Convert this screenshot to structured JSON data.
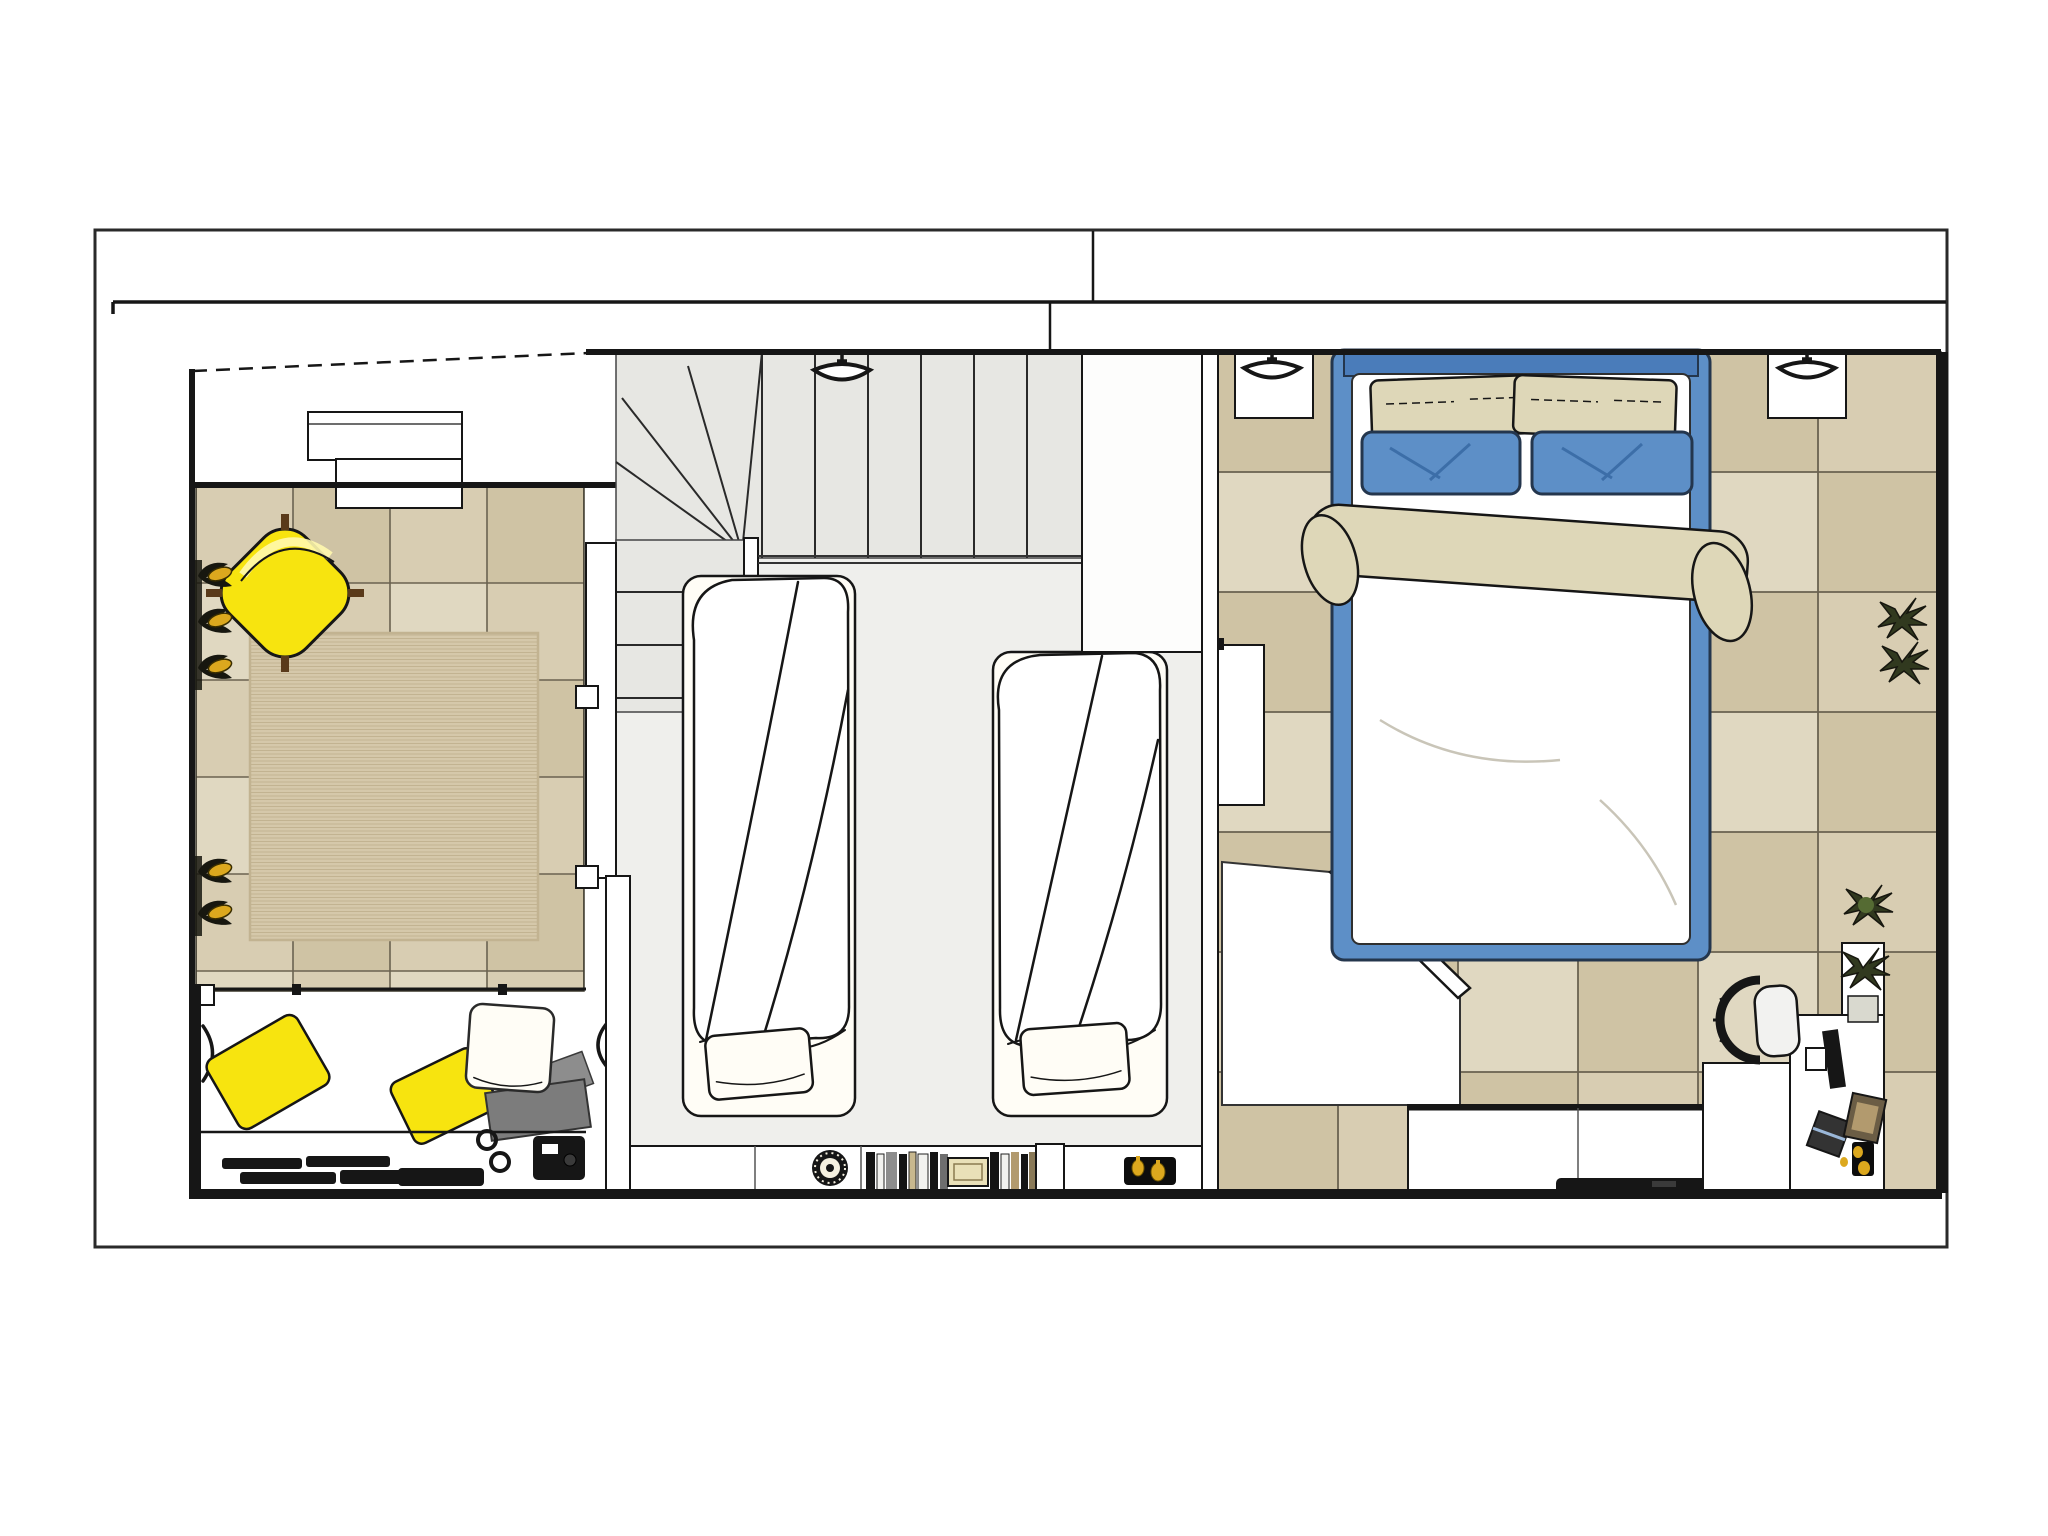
{
  "image": {
    "kind": "floor-plan-rendering",
    "title": "Upper floor furnished plan: living area, twin bedroom with staircase, master bedroom with desk",
    "width_px": 2048,
    "height_px": 1536,
    "visible_text": ""
  },
  "colors": {
    "paper": "#ffffff",
    "ink": "#161616",
    "line": "#2a2a2a",
    "tile-a": "#d8cdb2",
    "tile-b": "#cfc3a4",
    "tile-c": "#e0d8c1",
    "tile-grout": "#6a6250",
    "rug": "#d5c8aa",
    "rug-line": "#c2b391",
    "wood-stair": "#e7e7e3",
    "wood-floor": "#efefec",
    "accent-yellow": "#f7e40f",
    "yellow-deep": "#e3cd00",
    "bed-blue": "#5d8fc7",
    "blue-dark": "#24364d",
    "headboard-blue": "#4a7cba",
    "cream": "#ded7b8",
    "duvet": "#ffffff",
    "pillow-white": "#fffdf6",
    "gray-cushion": "#7c7c7c",
    "gray-light": "#8d8d8d",
    "plant-dark": "#17170f",
    "plant-green": "#31391f",
    "gold": "#dca81e",
    "wood-leg": "#5a3a1a",
    "box-cream": "#e9e0b8",
    "book-tan": "#b29a6e"
  },
  "rooms": [
    {
      "name": "living-area",
      "floor": "beige ceramic tiles",
      "items": [
        "yellow armchair",
        "jute rug",
        "sofa with yellow pillows",
        "media shelf with electronics",
        "flowering wall plants",
        "storage cabinet"
      ]
    },
    {
      "name": "twin-bedroom",
      "floor": "light wood",
      "items": [
        "winder staircase",
        "ceiling lamp",
        "single bed 1",
        "single bed 2",
        "low shelf with basket, books and perfume tray",
        "closet column"
      ]
    },
    {
      "name": "master-bedroom",
      "floor": "beige ceramic tiles",
      "items": [
        "double bed with blue frame",
        "two nightstands with sconces",
        "wall TV over sideboard",
        "desk with monitor, keyboard and laptop",
        "office chair",
        "plants"
      ]
    }
  ]
}
